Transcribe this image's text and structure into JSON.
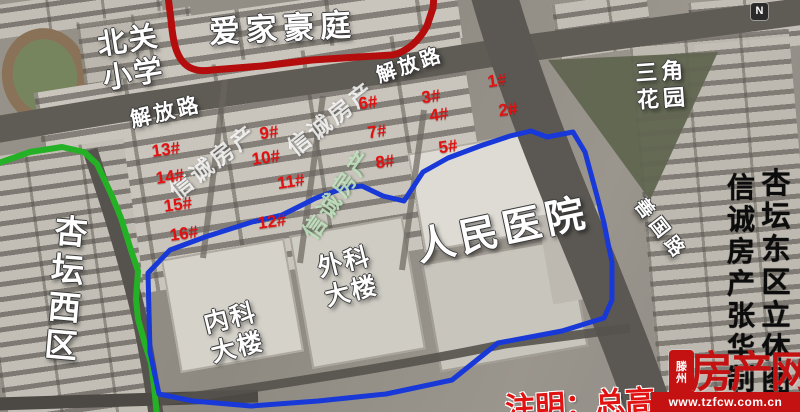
{
  "map": {
    "place_labels": [
      {
        "id": "aijia-haoting",
        "lines": [
          "爱家豪庭"
        ],
        "x": 283,
        "y": 29,
        "rot": -3,
        "size": 31,
        "spacing": 6
      },
      {
        "id": "beiguan-school",
        "lines": [
          "北关",
          "小学"
        ],
        "x": 131,
        "y": 58,
        "rot": -9,
        "size": 29,
        "spacing": 2
      },
      {
        "id": "jiefang-road-west",
        "lines": [
          "解放路"
        ],
        "x": 166,
        "y": 113,
        "rot": -13,
        "size": 21,
        "spacing": 3
      },
      {
        "id": "jiefang-road-east",
        "lines": [
          "解放路"
        ],
        "x": 410,
        "y": 66,
        "rot": -19,
        "size": 20,
        "spacing": 3
      },
      {
        "id": "sanjiao-garden",
        "lines": [
          "三角",
          "花园"
        ],
        "x": 662,
        "y": 85,
        "rot": -4,
        "size": 22,
        "spacing": 4
      },
      {
        "id": "shanguo-road",
        "lines": [
          "善国路"
        ],
        "x": 660,
        "y": 230,
        "rot": 52,
        "size": 19,
        "spacing": 5
      },
      {
        "id": "renmin-hospital",
        "lines": [
          "人民医院"
        ],
        "x": 503,
        "y": 231,
        "rot": -12,
        "size": 39,
        "spacing": 5
      },
      {
        "id": "waike-building",
        "lines": [
          "外科",
          "大楼"
        ],
        "x": 348,
        "y": 277,
        "rot": -14,
        "size": 25,
        "spacing": 2
      },
      {
        "id": "neike-building",
        "lines": [
          "内科",
          "大楼"
        ],
        "x": 234,
        "y": 333,
        "rot": -14,
        "size": 25,
        "spacing": 2
      },
      {
        "id": "xingtan-west",
        "lines": [
          "杏",
          "坛",
          "西",
          "区"
        ],
        "x": 66,
        "y": 289,
        "rot": 5,
        "size": 33,
        "spacing": 0
      }
    ],
    "building_numbers": [
      {
        "label": "1#",
        "x": 497,
        "y": 81
      },
      {
        "label": "2#",
        "x": 508,
        "y": 110
      },
      {
        "label": "3#",
        "x": 431,
        "y": 97
      },
      {
        "label": "4#",
        "x": 439,
        "y": 115
      },
      {
        "label": "5#",
        "x": 448,
        "y": 147
      },
      {
        "label": "6#",
        "x": 368,
        "y": 103
      },
      {
        "label": "7#",
        "x": 377,
        "y": 132
      },
      {
        "label": "8#",
        "x": 385,
        "y": 162
      },
      {
        "label": "9#",
        "x": 269,
        "y": 133
      },
      {
        "label": "10#",
        "x": 266,
        "y": 158
      },
      {
        "label": "11#",
        "x": 291,
        "y": 182
      },
      {
        "label": "12#",
        "x": 272,
        "y": 222
      },
      {
        "label": "13#",
        "x": 166,
        "y": 150
      },
      {
        "label": "14#",
        "x": 170,
        "y": 177
      },
      {
        "label": "15#",
        "x": 178,
        "y": 205
      },
      {
        "label": "16#",
        "x": 184,
        "y": 234
      }
    ],
    "watermarks": [
      {
        "text": "信诚房产",
        "x": 212,
        "y": 160,
        "rot": -38,
        "tint": "white"
      },
      {
        "text": "信诚房产",
        "x": 330,
        "y": 117,
        "rot": -38,
        "tint": "white"
      },
      {
        "text": "信诚房产",
        "x": 336,
        "y": 193,
        "rot": -55,
        "tint": "green"
      }
    ],
    "vertical_columns": [
      {
        "id": "map-title",
        "text": "杏坛东区立体图",
        "x": 776,
        "y": 168,
        "size": 29,
        "step": 33
      },
      {
        "id": "agency-credit",
        "text": "信诚房产张华制",
        "x": 741,
        "y": 172,
        "size": 28,
        "step": 32
      }
    ]
  },
  "note": {
    "text": "注明：总高"
  },
  "logo": {
    "city": "滕州",
    "site": "房产网",
    "url": "www.tzfcw.com.cn"
  },
  "compass": {
    "label": "N"
  },
  "colors": {
    "boundary_red": "#b40d0d",
    "boundary_green": "#25b125",
    "boundary_blue": "#1838d8",
    "number_red": "#e31212",
    "label_white": "#ffffff",
    "column_black": "#0c0c0c",
    "logo_red": "#c41212"
  }
}
